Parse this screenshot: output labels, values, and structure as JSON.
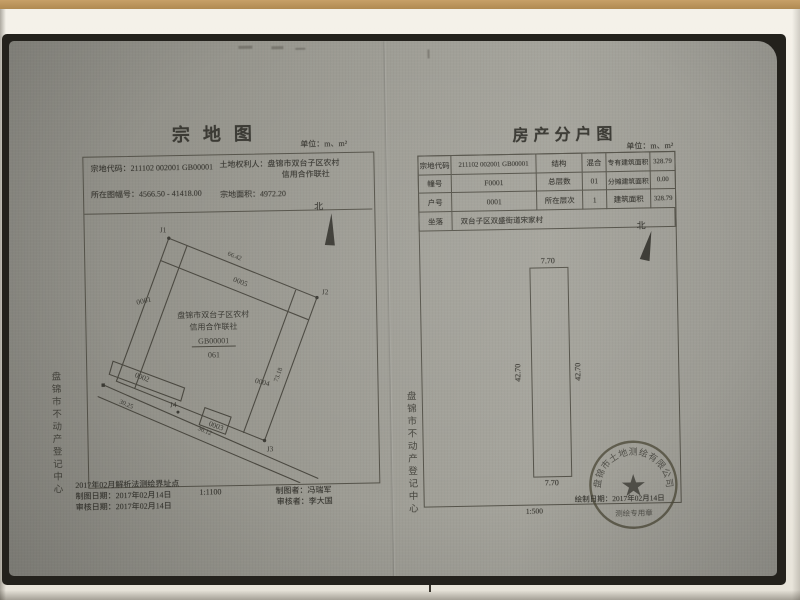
{
  "colors": {
    "paper": "#f0ede5",
    "scan_background": "#9a9991",
    "ink": "#3a3933",
    "seal": "#4e4b3a",
    "wood": "#b08a52"
  },
  "parcel_map": {
    "title": "宗地图",
    "unit": "单位：m、m²",
    "fields": {
      "code_label": "宗地代码：",
      "code": "211102 002001 GB00001",
      "holder_label": "土地权利人：",
      "holder_line1": "盘锦市双台子区农村",
      "holder_line2": "信用合作联社",
      "sheet_label": "所在图幅号：",
      "sheet": "4566.50 - 41418.00",
      "area_label": "宗地面积：",
      "area": "4972.20"
    },
    "north": "北",
    "map": {
      "j1": "J1",
      "j2": "J2",
      "j3": "J3",
      "j4": "J4",
      "p0001": "0001",
      "p0002": "0002",
      "p0003": "0003",
      "p0004": "0004",
      "p0005": "0005",
      "owner_line1": "盘锦市双台子区农村",
      "owner_line2": "信用合作联社",
      "code": "GB00001",
      "number": "061",
      "measure_top": "66.42",
      "measure_right": "73.18",
      "measure_road1": "30.25",
      "measure_road2": "36.12"
    },
    "footer": {
      "note": "2017年02月解析法测绘界址点",
      "draw_date": "制图日期：2017年02月14日",
      "review_date": "审核日期：2017年02月14日",
      "scale": "1:1100",
      "drafter": "制图者：冯瑞军",
      "reviewer": "审核者：李大国"
    },
    "margin_text": "盘锦市不动产登记中心"
  },
  "floor_plan": {
    "title": "房产分户图",
    "unit": "单位：m、m²",
    "table": {
      "r1c1": "宗地代码",
      "r1c2": "211102 002001 GB00001",
      "r1c3": "结构",
      "r1c4": "混合",
      "r1c5": "专有建筑面积",
      "r1c6": "328.79",
      "r2c1": "幢号",
      "r2c2": "F0001",
      "r2c3": "总层数",
      "r2c4": "01",
      "r2c5": "分摊建筑面积",
      "r2c6": "0.00",
      "r3c1": "户号",
      "r3c2": "0001",
      "r3c3": "所在层次",
      "r3c4": "1",
      "r3c5": "建筑面积",
      "r3c6": "328.79",
      "r4c1": "坐落",
      "r4c2": "双台子区双盛街道宋家村"
    },
    "north": "北",
    "plan": {
      "width_top": "7.70",
      "width_bottom": "7.70",
      "height_left": "42.70",
      "height_right": "42.70"
    },
    "scale": "1:500",
    "seal": {
      "ring_text": "盘锦市土地测绘有限公司",
      "bottom_text": "测绘专用章",
      "date": "绘制日期：2017年02月14日"
    },
    "margin_text": "盘锦市不动产登记中心"
  }
}
